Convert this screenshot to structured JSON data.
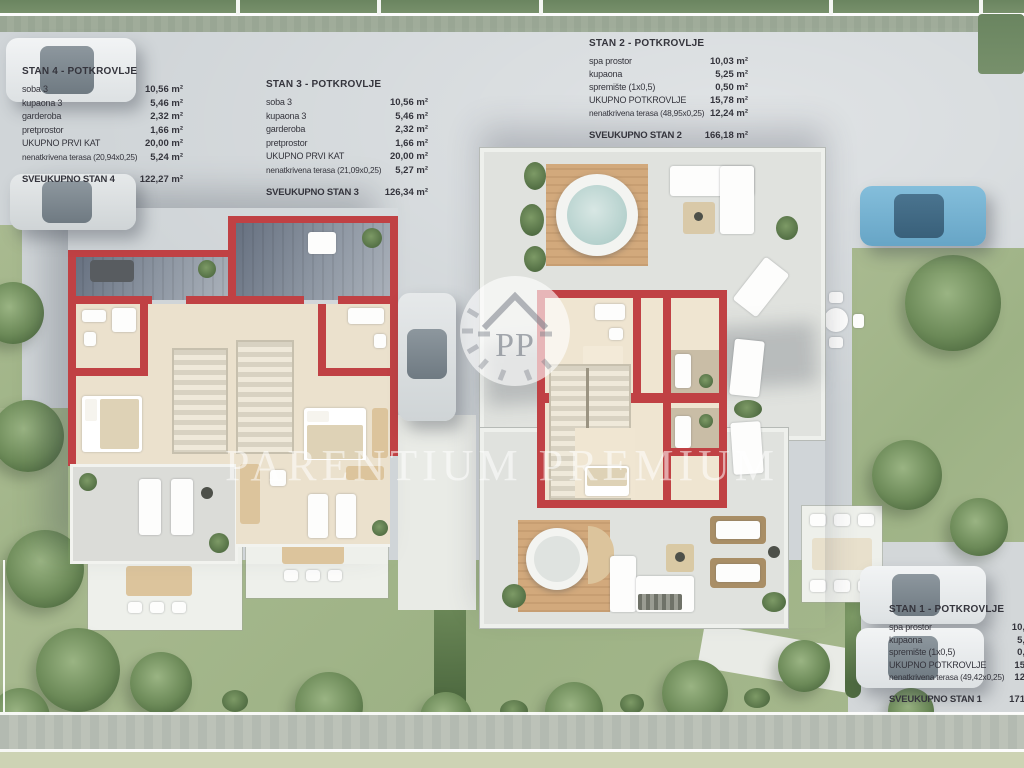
{
  "watermark": {
    "text": "PARENTIUM PREMIUM",
    "monogram": "PP"
  },
  "panels": {
    "stan4": {
      "title": "STAN 4 - POTKROVLJE",
      "rows": [
        {
          "label": "soba 3",
          "value": "10,56 m²"
        },
        {
          "label": "kupaona 3",
          "value": "5,46 m²"
        },
        {
          "label": "garderoba",
          "value": "2,32 m²"
        },
        {
          "label": "pretprostor",
          "value": "1,66 m²"
        },
        {
          "label": "UKUPNO PRVI KAT",
          "value": "20,00 m²"
        },
        {
          "label": "nenatkrivena terasa  (20,94x0,25)",
          "value": "5,24 m²"
        }
      ],
      "total": {
        "label": "SVEUKUPNO STAN 4",
        "value": "122,27 m²"
      }
    },
    "stan3": {
      "title": "STAN 3 - POTKROVLJE",
      "rows": [
        {
          "label": "soba 3",
          "value": "10,56 m²"
        },
        {
          "label": "kupaona 3",
          "value": "5,46 m²"
        },
        {
          "label": "garderoba",
          "value": "2,32 m²"
        },
        {
          "label": "pretprostor",
          "value": "1,66 m²"
        },
        {
          "label": "UKUPNO PRVI KAT",
          "value": "20,00 m²"
        },
        {
          "label": "nenatkrivena terasa  (21,09x0,25)",
          "value": "5,27 m²"
        }
      ],
      "total": {
        "label": "SVEUKUPNO STAN 3",
        "value": "126,34 m²"
      }
    },
    "stan2": {
      "title": "STAN 2 - POTKROVLJE",
      "rows": [
        {
          "label": "spa prostor",
          "value": "10,03 m²"
        },
        {
          "label": "kupaona",
          "value": "5,25 m²"
        },
        {
          "label": "spremište (1x0,5)",
          "value": "0,50 m²"
        },
        {
          "label": "UKUPNO POTKROVLJE",
          "value": "15,78 m²"
        },
        {
          "label": "nenatkrivena terasa  (48,95x0,25)",
          "value": "12,24 m²"
        }
      ],
      "total": {
        "label": "SVEUKUPNO STAN 2",
        "value": "166,18 m²"
      }
    },
    "stan1": {
      "title": "STAN 1 - POTKROVLJE",
      "rows": [
        {
          "label": "spa prostor",
          "value": "10,"
        },
        {
          "label": "kupaona",
          "value": "5,"
        },
        {
          "label": "spremište (1x0,5)",
          "value": "0,"
        },
        {
          "label": "UKUPNO POTKROVLJE",
          "value": "15"
        },
        {
          "label": "nenatkrivena terasa  (49,42x0,25)",
          "value": "12"
        }
      ],
      "total": {
        "label": "SVEUKUPNO STAN 1",
        "value": "171"
      }
    }
  },
  "colors": {
    "wall_red": "#c04144",
    "plaza_gray": "#d0d5d8",
    "lawn_green": "#a3b68b",
    "car_blue": "#7ab5d4",
    "text_dark": "#34343c",
    "watermark_white": "#ffffff"
  }
}
